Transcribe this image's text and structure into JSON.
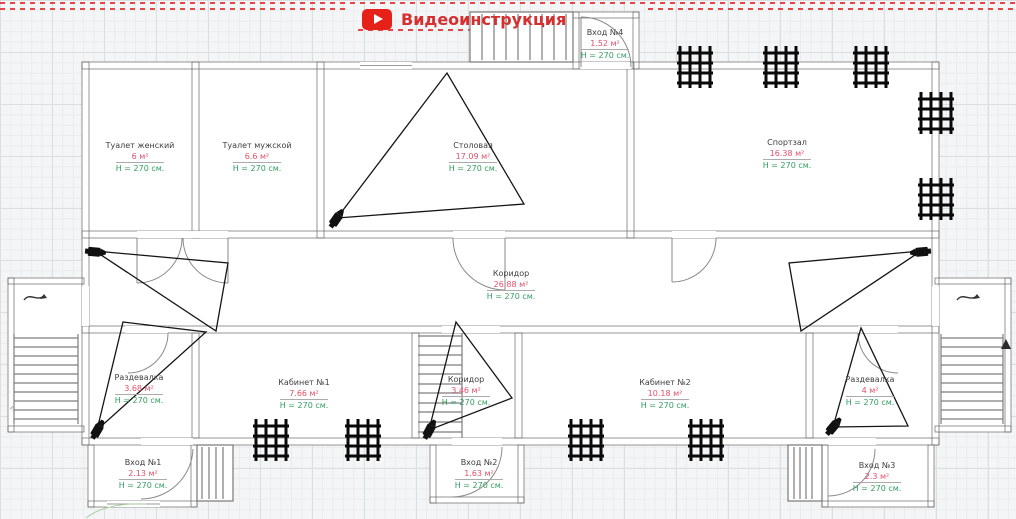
{
  "header": {
    "video_label": "Видеоинструкция",
    "video_icon": "youtube-play-icon"
  },
  "plan": {
    "rooms": {
      "toilet_women": {
        "name": "Туалет женский",
        "area": "6 м²",
        "height": "H = 270 см."
      },
      "toilet_men": {
        "name": "Туалет мужской",
        "area": "6.6 м²",
        "height": "H = 270 см."
      },
      "dining": {
        "name": "Столовая",
        "area": "17.09 м²",
        "height": "H = 270 см."
      },
      "gym": {
        "name": "Спортзал",
        "area": "16.38 м²",
        "height": "H = 270 см."
      },
      "corridor_main": {
        "name": "Коридор",
        "area": "26.88 м²",
        "height": "H = 270 см."
      },
      "locker_left": {
        "name": "Раздевалка",
        "area": "3.68 м²",
        "height": "H = 270 см."
      },
      "cabinet1": {
        "name": "Кабинет №1",
        "area": "7.66 м²",
        "height": "H = 270 см."
      },
      "corridor_small": {
        "name": "Коридор",
        "area": "3.46 м²",
        "height": "H = 270 см."
      },
      "cabinet2": {
        "name": "Кабинет №2",
        "area": "10.18 м²",
        "height": "H = 270 см."
      },
      "locker_right": {
        "name": "Раздевалка",
        "area": "4 м²",
        "height": "H = 270 см."
      },
      "entrance1": {
        "name": "Вход №1",
        "area": "2.13 м²",
        "height": "H = 270 см."
      },
      "entrance2": {
        "name": "Вход №2",
        "area": "1.63 м²",
        "height": "H = 270 см."
      },
      "entrance3": {
        "name": "Вход №3",
        "area": "2.3 м²",
        "height": "H = 270 см."
      },
      "entrance4": {
        "name": "Вход №4",
        "area": "1.52 м²",
        "height": "H = 270 см."
      }
    },
    "camera_count": 6,
    "window_grill_count": 9
  },
  "colors": {
    "accent_red_dashes": "#e24646",
    "youtube_red": "#e62117",
    "title_red": "#d52f2f",
    "area_text": "#e0516b",
    "height_text": "#2f9e5f",
    "wall_outline": "#686868",
    "room_name_text": "#3e3e3e"
  }
}
